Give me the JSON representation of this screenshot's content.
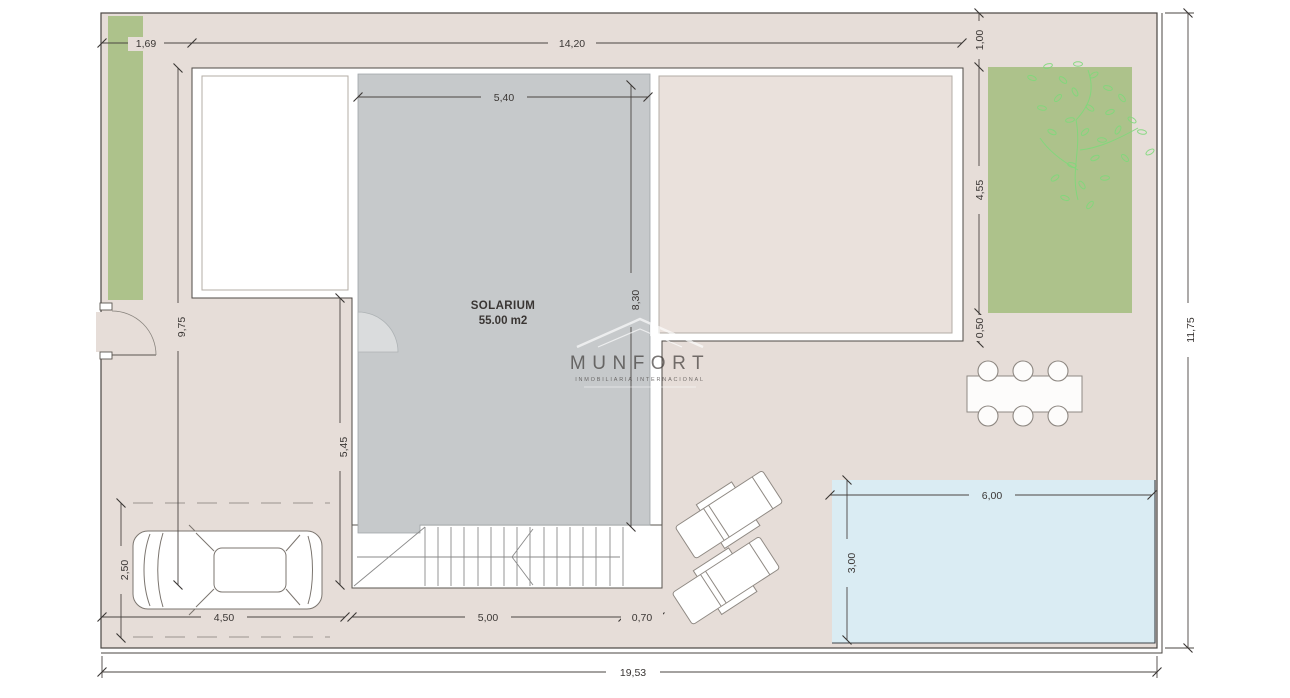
{
  "plan": {
    "solarium": {
      "name": "SOLARIUM",
      "area": "55.00 m2"
    },
    "dims": {
      "strip_width": "1,69",
      "building_width": "14,20",
      "garden_offset_top": "1,00",
      "garden_height": "4,55",
      "garden_offset_bottom": "0,50",
      "solarium_width": "5,40",
      "solarium_length": "8,30",
      "building_depth": "9,75",
      "terrace_depth": "5,45",
      "parking_depth": "2,50",
      "parking_width": "4,50",
      "stairs_width": "5,00",
      "landing_width": "0,70",
      "pool_width": "6,00",
      "pool_depth": "3,00",
      "plot_depth": "11,75",
      "plot_width": "19,53"
    }
  },
  "watermark": {
    "brand": "MUNFORT",
    "tagline": "INMOBILIARIA INTERNACIONAL"
  },
  "colors": {
    "terrace": "#e6ddd8",
    "room": "#eae1dc",
    "solarium": "#c6c9cb",
    "garden": "#adc28b",
    "tree": "#7fd97b",
    "pool": "#daecf3",
    "wall": "#ffffff",
    "line": "#4a4542",
    "dim_text": "#3a3634"
  }
}
